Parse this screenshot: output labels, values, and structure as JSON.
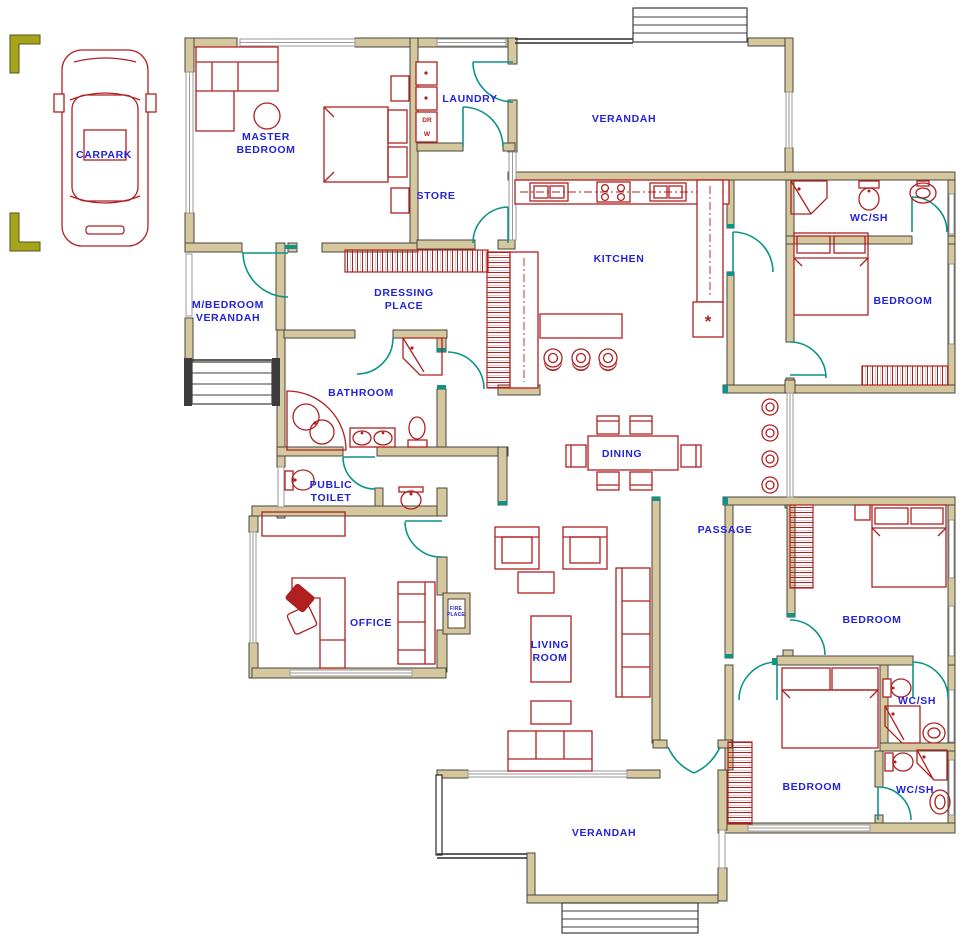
{
  "colors": {
    "wall_fill": "#d5c79e",
    "wall_stroke": "#4a463c",
    "furniture_red": "#b02020",
    "door_teal": "#0d9488",
    "label_blue": "#2323dc",
    "window_gray": "#9a9a9a",
    "marker_olive": "#a6a41a",
    "floor_white": "#ffffff"
  },
  "labels": {
    "carpark": "CARPARK",
    "master_1": "MASTER",
    "master_2": "BEDROOM",
    "laundry": "LAUNDRY",
    "verandah_top": "VERANDAH",
    "store": "STORE",
    "kitchen": "KITCHEN",
    "wcsh_ne": "WC/SH",
    "bedroom_ne": "BEDROOM",
    "mbv_1": "M/BEDROOM",
    "mbv_2": "VERANDAH",
    "dressing_1": "DRESSING",
    "dressing_2": "PLACE",
    "bathroom": "BATHROOM",
    "public_1": "PUBLIC",
    "public_2": "TOILET",
    "dining": "DINING",
    "passage": "PASSAGE",
    "office": "OFFICE",
    "fire_1": "FIRE",
    "fire_2": "PLACE",
    "living_1": "LIVING",
    "living_2": "ROOM",
    "bedroom_mid": "BEDROOM",
    "wcsh_mid": "WC/SH",
    "bedroom_s": "BEDROOM",
    "wcsh_s": "WC/SH",
    "verandah_bottom": "VERANDAH",
    "washer": "W",
    "dryer": "DR",
    "cooker": "*"
  }
}
